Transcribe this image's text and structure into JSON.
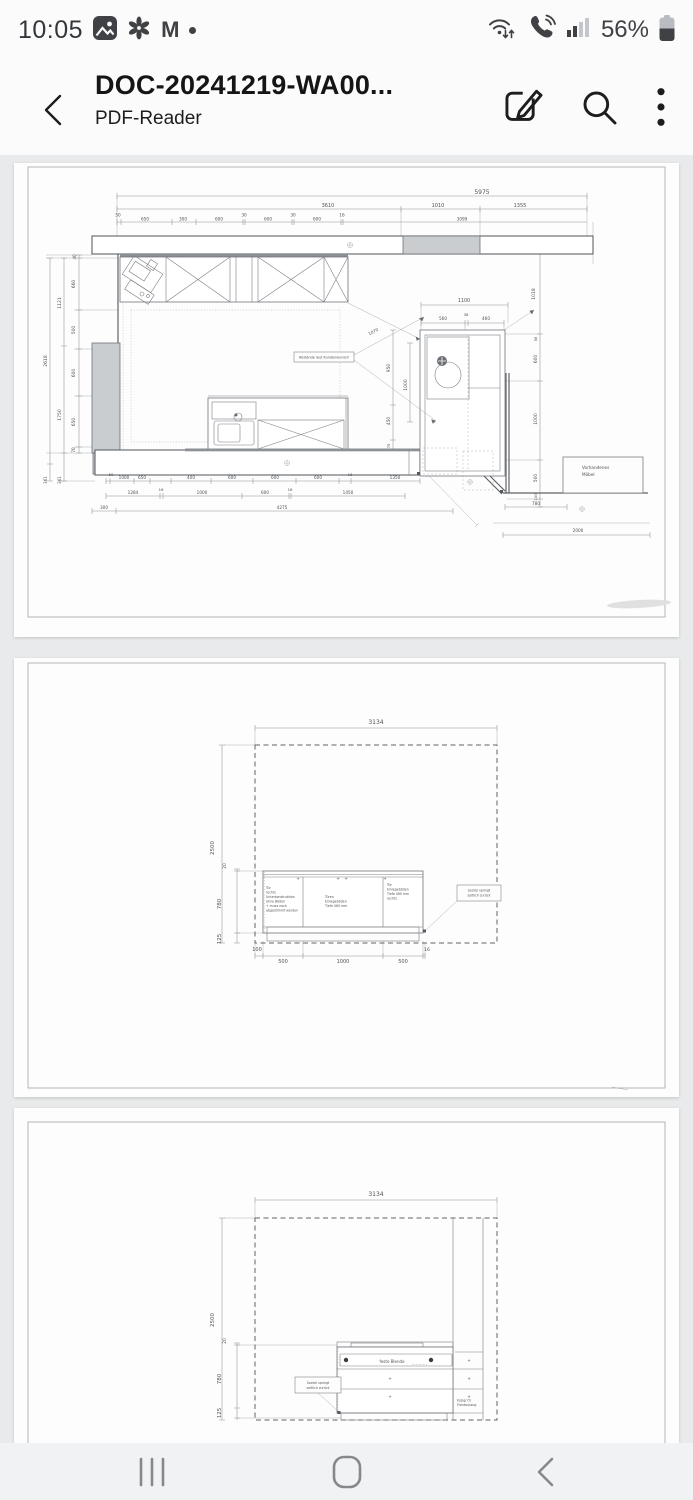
{
  "status_bar": {
    "time": "10:05",
    "battery_percent": "56%",
    "gmail_glyph": "M",
    "left_icons": [
      "gallery-icon",
      "flower-icon",
      "gmail-icon",
      "notification-dot"
    ],
    "right_icons": [
      "wifi-arrows-icon",
      "wifi-calling-icon",
      "signal-strength-icon",
      "battery-icon"
    ]
  },
  "app_bar": {
    "title": "DOC-20241219-WA00...",
    "subtitle": "PDF-Reader",
    "actions": [
      "edit-icon",
      "search-icon",
      "more-icon"
    ]
  },
  "nav_bar": {
    "buttons": [
      "recents",
      "home",
      "back"
    ]
  },
  "colors": {
    "content_bg": "#e9eaeb",
    "page_bg": "#fdfdfd",
    "drawing_gray": "#c9cdd0",
    "icon_dark": "#3f4145"
  },
  "pages": {
    "page1": {
      "labels": [
        {
          "t": "5975",
          "x": 468,
          "y": 31,
          "s": 6
        },
        {
          "t": "3610",
          "x": 314,
          "y": 44,
          "s": 5
        },
        {
          "t": "1010",
          "x": 424,
          "y": 44,
          "s": 5
        },
        {
          "t": "1355",
          "x": 506,
          "y": 44,
          "s": 5
        },
        {
          "t": "50",
          "x": 104,
          "y": 53.5,
          "s": 4.2
        },
        {
          "t": "650",
          "x": 131,
          "y": 57.5,
          "s": 4.2
        },
        {
          "t": "300",
          "x": 169,
          "y": 57.5,
          "s": 4.2
        },
        {
          "t": "600",
          "x": 205,
          "y": 57.5,
          "s": 4.2
        },
        {
          "t": "30",
          "x": 230,
          "y": 53.5,
          "s": 4.2
        },
        {
          "t": "600",
          "x": 254,
          "y": 57.5,
          "s": 4.2
        },
        {
          "t": "30",
          "x": 279,
          "y": 53.5,
          "s": 4.2
        },
        {
          "t": "600",
          "x": 303,
          "y": 57.5,
          "s": 4.2
        },
        {
          "t": "16",
          "x": 328,
          "y": 53.5,
          "s": 4.2
        },
        {
          "t": "3099",
          "x": 448,
          "y": 57.5,
          "s": 4.2
        },
        {
          "t": "40",
          "x": 62,
          "y": 94,
          "s": 4.2,
          "r": -90
        },
        {
          "t": "660",
          "x": 61,
          "y": 121,
          "s": 4.5,
          "r": -90
        },
        {
          "t": "500",
          "x": 61,
          "y": 167,
          "s": 4.5,
          "r": -90
        },
        {
          "t": "600",
          "x": 61,
          "y": 210,
          "s": 4.5,
          "r": -90
        },
        {
          "t": "650",
          "x": 61,
          "y": 259,
          "s": 4.5,
          "r": -90
        },
        {
          "t": "70",
          "x": 61,
          "y": 287,
          "s": 4.2,
          "r": -90
        },
        {
          "t": "1121",
          "x": 47,
          "y": 140,
          "s": 4.5,
          "r": -90
        },
        {
          "t": "1750",
          "x": 47,
          "y": 252,
          "s": 4.5,
          "r": -90
        },
        {
          "t": "2618",
          "x": 33,
          "y": 198,
          "s": 4.5,
          "r": -90
        },
        {
          "t": "361",
          "x": 33,
          "y": 317,
          "s": 4,
          "r": -90
        },
        {
          "t": "361",
          "x": 47,
          "y": 317,
          "s": 4,
          "r": -90
        },
        {
          "t": "1100",
          "x": 450,
          "y": 139,
          "s": 4.8
        },
        {
          "t": "560",
          "x": 429,
          "y": 157,
          "s": 4.2
        },
        {
          "t": "38",
          "x": 452,
          "y": 153,
          "s": 3.8
        },
        {
          "t": "460",
          "x": 472,
          "y": 157,
          "s": 4.2
        },
        {
          "t": "1070",
          "x": 360,
          "y": 170,
          "s": 4.2,
          "r": -28
        },
        {
          "t": "1018",
          "x": 521,
          "y": 131,
          "s": 4.5,
          "r": -90
        },
        {
          "t": "56",
          "x": 523,
          "y": 176,
          "s": 3.8,
          "r": -90
        },
        {
          "t": "600",
          "x": 523,
          "y": 196,
          "s": 4.5,
          "r": -90
        },
        {
          "t": "1000",
          "x": 523,
          "y": 256,
          "s": 4.5,
          "r": -90
        },
        {
          "t": "500",
          "x": 523,
          "y": 315,
          "s": 4.5,
          "r": -90
        },
        {
          "t": "100",
          "x": 523,
          "y": 334,
          "s": 3.8,
          "r": -90
        },
        {
          "t": "1000",
          "x": 393,
          "y": 222,
          "s": 4.5,
          "r": -90
        },
        {
          "t": "950",
          "x": 376,
          "y": 205,
          "s": 4.5,
          "r": -90
        },
        {
          "t": "450",
          "x": 376,
          "y": 258,
          "s": 4.5,
          "r": -90
        },
        {
          "t": "75",
          "x": 376,
          "y": 283,
          "s": 3.8,
          "r": -90
        },
        {
          "t": "50",
          "x": 97,
          "y": 313,
          "s": 3.8
        },
        {
          "t": "1000",
          "x": 110,
          "y": 316,
          "s": 4.2
        },
        {
          "t": "650",
          "x": 128,
          "y": 316,
          "s": 4.2
        },
        {
          "t": "400",
          "x": 177,
          "y": 316,
          "s": 4.2
        },
        {
          "t": "600",
          "x": 218,
          "y": 316,
          "s": 4.2
        },
        {
          "t": "600",
          "x": 261,
          "y": 316,
          "s": 4.2
        },
        {
          "t": "600",
          "x": 304,
          "y": 316,
          "s": 4.2
        },
        {
          "t": "16",
          "x": 336,
          "y": 313,
          "s": 3.8
        },
        {
          "t": "1350",
          "x": 381,
          "y": 316,
          "s": 4.2
        },
        {
          "t": "1284",
          "x": 119,
          "y": 331,
          "s": 4.2
        },
        {
          "t": "16",
          "x": 147,
          "y": 328,
          "s": 3.8
        },
        {
          "t": "1000",
          "x": 188,
          "y": 331,
          "s": 4.2
        },
        {
          "t": "600",
          "x": 251,
          "y": 331,
          "s": 4.2
        },
        {
          "t": "16",
          "x": 276,
          "y": 328,
          "s": 3.8
        },
        {
          "t": "1450",
          "x": 334,
          "y": 331,
          "s": 4.2
        },
        {
          "t": "300",
          "x": 90,
          "y": 346,
          "s": 4.2
        },
        {
          "t": "4275",
          "x": 268,
          "y": 346,
          "s": 4.2
        },
        {
          "t": "780",
          "x": 522,
          "y": 342,
          "s": 4.2
        },
        {
          "t": "2000",
          "x": 564,
          "y": 369,
          "s": 4.2
        },
        {
          "t": "Abstände laut Kundenwunsch",
          "x": 310,
          "y": 195.5,
          "s": 3.4
        },
        {
          "t": "Vorhandenes",
          "x": 568,
          "y": 306,
          "s": 4.2,
          "a": "start"
        },
        {
          "t": "Möbel",
          "x": 568,
          "y": 313,
          "s": 4.2,
          "a": "start"
        }
      ]
    },
    "page2": {
      "labels": [
        {
          "t": "3134",
          "x": 362,
          "y": 66,
          "s": 6
        },
        {
          "t": "2500",
          "x": 200,
          "y": 190,
          "s": 5.5,
          "r": -90
        },
        {
          "t": "20",
          "x": 212,
          "y": 208,
          "s": 4.5,
          "r": -90
        },
        {
          "t": "780",
          "x": 207,
          "y": 246,
          "s": 5.5,
          "r": -90
        },
        {
          "t": "125",
          "x": 207,
          "y": 281,
          "s": 5.5,
          "r": -90
        },
        {
          "t": "100",
          "x": 243,
          "y": 293,
          "s": 5
        },
        {
          "t": "500",
          "x": 269,
          "y": 305,
          "s": 5
        },
        {
          "t": "1000",
          "x": 329,
          "y": 305,
          "s": 5
        },
        {
          "t": "500",
          "x": 389,
          "y": 305,
          "s": 5
        },
        {
          "t": "16",
          "x": 413,
          "y": 293,
          "s": 4.5
        },
        {
          "t": "+",
          "x": 284,
          "y": 222,
          "s": 4
        },
        {
          "t": "+",
          "x": 324,
          "y": 222,
          "s": 4
        },
        {
          "t": "+",
          "x": 332,
          "y": 222,
          "s": 4
        },
        {
          "t": "+",
          "x": 371,
          "y": 222,
          "s": 4
        },
        {
          "t": "Tür",
          "x": 252,
          "y": 231,
          "s": 3.2,
          "a": "start"
        },
        {
          "t": "rechts",
          "x": 252,
          "y": 235.5,
          "s": 3.2,
          "a": "start"
        },
        {
          "t": "Unterkonstruktion",
          "x": 252,
          "y": 240,
          "s": 3.2,
          "a": "start"
        },
        {
          "t": "ohne Böden",
          "x": 252,
          "y": 244.5,
          "s": 3.2,
          "a": "start"
        },
        {
          "t": "+ muss noch",
          "x": 252,
          "y": 249,
          "s": 3.2,
          "a": "start"
        },
        {
          "t": "abgestimmt werden",
          "x": 252,
          "y": 253.5,
          "s": 3.2,
          "a": "start"
        },
        {
          "t": "Türen",
          "x": 311,
          "y": 240,
          "s": 3.2,
          "a": "start"
        },
        {
          "t": "Einlegeböden",
          "x": 311,
          "y": 244.5,
          "s": 3.2,
          "a": "start"
        },
        {
          "t": "Tiefe 460 mm",
          "x": 311,
          "y": 249,
          "s": 3.2,
          "a": "start"
        },
        {
          "t": "Tür",
          "x": 373,
          "y": 228,
          "s": 3.2,
          "a": "start"
        },
        {
          "t": "Einlegeböden",
          "x": 373,
          "y": 232.5,
          "s": 3.2,
          "a": "start"
        },
        {
          "t": "Tiefe 460 mm",
          "x": 373,
          "y": 237,
          "s": 3.2,
          "a": "start"
        },
        {
          "t": "rechts",
          "x": 373,
          "y": 241.5,
          "s": 3.2,
          "a": "start"
        },
        {
          "t": "Sockel springt",
          "x": 465,
          "y": 233.5,
          "s": 3.2
        },
        {
          "t": "seitlich zurück",
          "x": 465,
          "y": 238.5,
          "s": 3.2
        }
      ]
    },
    "page3": {
      "labels": [
        {
          "t": "3134",
          "x": 362,
          "y": 88,
          "s": 6
        },
        {
          "t": "2500",
          "x": 200,
          "y": 212,
          "s": 5.5,
          "r": -90
        },
        {
          "t": "20",
          "x": 212,
          "y": 233,
          "s": 4.5,
          "r": -90
        },
        {
          "t": "780",
          "x": 207,
          "y": 271,
          "s": 5.5,
          "r": -90
        },
        {
          "t": "125",
          "x": 207,
          "y": 305,
          "s": 5.5,
          "r": -90
        },
        {
          "t": "feste Blende",
          "x": 378,
          "y": 255,
          "s": 4
        },
        {
          "t": "+",
          "x": 455,
          "y": 254,
          "s": 4
        },
        {
          "t": "+",
          "x": 376,
          "y": 272,
          "s": 4
        },
        {
          "t": "+",
          "x": 455,
          "y": 272,
          "s": 4
        },
        {
          "t": "+",
          "x": 376,
          "y": 290,
          "s": 4
        },
        {
          "t": "+",
          "x": 455,
          "y": 290,
          "s": 4
        },
        {
          "t": "Essig/ Öl",
          "x": 443,
          "y": 293.5,
          "s": 3.2,
          "a": "start"
        },
        {
          "t": "Frontauszug",
          "x": 443,
          "y": 298,
          "s": 3.2,
          "a": "start"
        },
        {
          "t": "Sockel springt",
          "x": 304,
          "y": 276,
          "s": 3.2
        },
        {
          "t": "seitlich zurück",
          "x": 304,
          "y": 281,
          "s": 3.2
        }
      ]
    }
  }
}
